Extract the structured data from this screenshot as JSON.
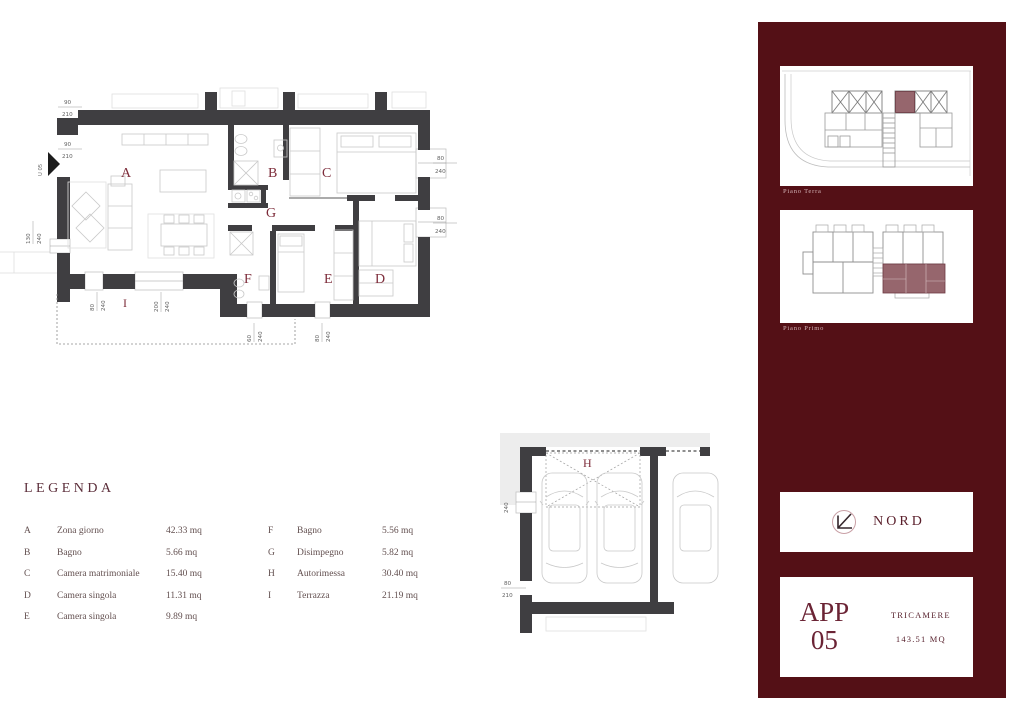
{
  "legend": {
    "title": "LEGENDA",
    "col1": [
      {
        "key": "A",
        "name": "Zona giorno",
        "value": "42.33 mq"
      },
      {
        "key": "B",
        "name": "Bagno",
        "value": "5.66 mq"
      },
      {
        "key": "C",
        "name": "Camera matrimoniale",
        "value": "15.40 mq"
      },
      {
        "key": "D",
        "name": "Camera singola",
        "value": "11.31 mq"
      },
      {
        "key": "E",
        "name": "Camera singola",
        "value": "9.89 mq"
      }
    ],
    "col2": [
      {
        "key": "F",
        "name": "Bagno",
        "value": "5.56 mq"
      },
      {
        "key": "G",
        "name": "Disimpegno",
        "value": "5.82 mq"
      },
      {
        "key": "H",
        "name": "Autorimessa",
        "value": "30.40 mq"
      },
      {
        "key": "I",
        "name": "Terrazza",
        "value": "21.19 mq"
      }
    ]
  },
  "plan": {
    "rooms": {
      "a": "A",
      "b": "B",
      "c": "C",
      "d": "D",
      "e": "E",
      "f": "F",
      "g": "G",
      "i": "I"
    },
    "entrance_label": "U 05",
    "dims": {
      "d90": "90",
      "d210": "210",
      "d240": "240",
      "d130": "130",
      "d80": "80",
      "d200": "200",
      "d60": "60"
    }
  },
  "garage": {
    "room_label": "H",
    "dims": {
      "d240": "240",
      "d80": "80",
      "d210": "210"
    }
  },
  "sidebar": {
    "floor_cards": [
      {
        "label": "Piano Terra"
      },
      {
        "label": "Piano Primo"
      }
    ],
    "compass": {
      "label": "NORD"
    },
    "app_card": {
      "name_line1": "APP",
      "name_line2": "05",
      "type": "TRICAMERE",
      "area": "143.51 MQ"
    }
  },
  "colors": {
    "sidebar_bg": "#541016",
    "highlight": "#96666d",
    "wall": "#3f3e41",
    "accent": "#5a1f2b"
  }
}
